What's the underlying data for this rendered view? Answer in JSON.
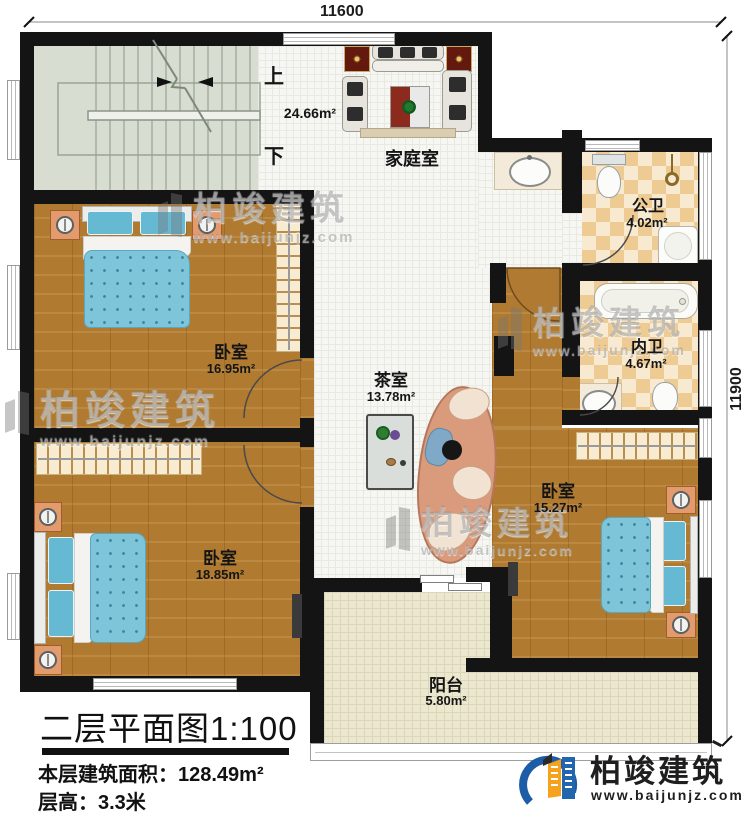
{
  "dimensions": {
    "width_mm": "11600",
    "height_mm": "11900"
  },
  "stairs": {
    "up_label": "上",
    "down_label": "下"
  },
  "rooms": {
    "family": {
      "name": "家庭室",
      "area": "24.66m²"
    },
    "public_bath": {
      "name": "公卫",
      "area": "4.02m²"
    },
    "inner_bath": {
      "name": "内卫",
      "area": "4.67m²"
    },
    "bedroom_top_left": {
      "name": "卧室",
      "area": "16.95m²"
    },
    "tea_room": {
      "name": "茶室",
      "area": "13.78m²"
    },
    "bedroom_bottom_left": {
      "name": "卧室",
      "area": "18.85m²"
    },
    "bedroom_right": {
      "name": "卧室",
      "area": "15.27m²"
    },
    "balcony": {
      "name": "阳台",
      "area": "5.80m²"
    }
  },
  "title_block": {
    "plan_title": "二层平面图1:100",
    "floor_area_label": "本层建筑面积：",
    "floor_area_value": "128.49m²",
    "floor_height": "层高：3.3米"
  },
  "brand": {
    "name": "柏竣建筑",
    "website": "www.baijunjz.com"
  },
  "watermark": {
    "name": "柏竣建筑",
    "website": "www.baijunjz.com"
  },
  "colors": {
    "wall": "#141414",
    "wood_floor": "#b07a30",
    "checker_tile": "#eecb93",
    "stair_floor": "#d8ddd2",
    "balcony_floor": "#ece7cf",
    "bed_blue": "#7fc5da",
    "brand_blue": "#1d5ca6",
    "brand_orange": "#f6a21c"
  }
}
